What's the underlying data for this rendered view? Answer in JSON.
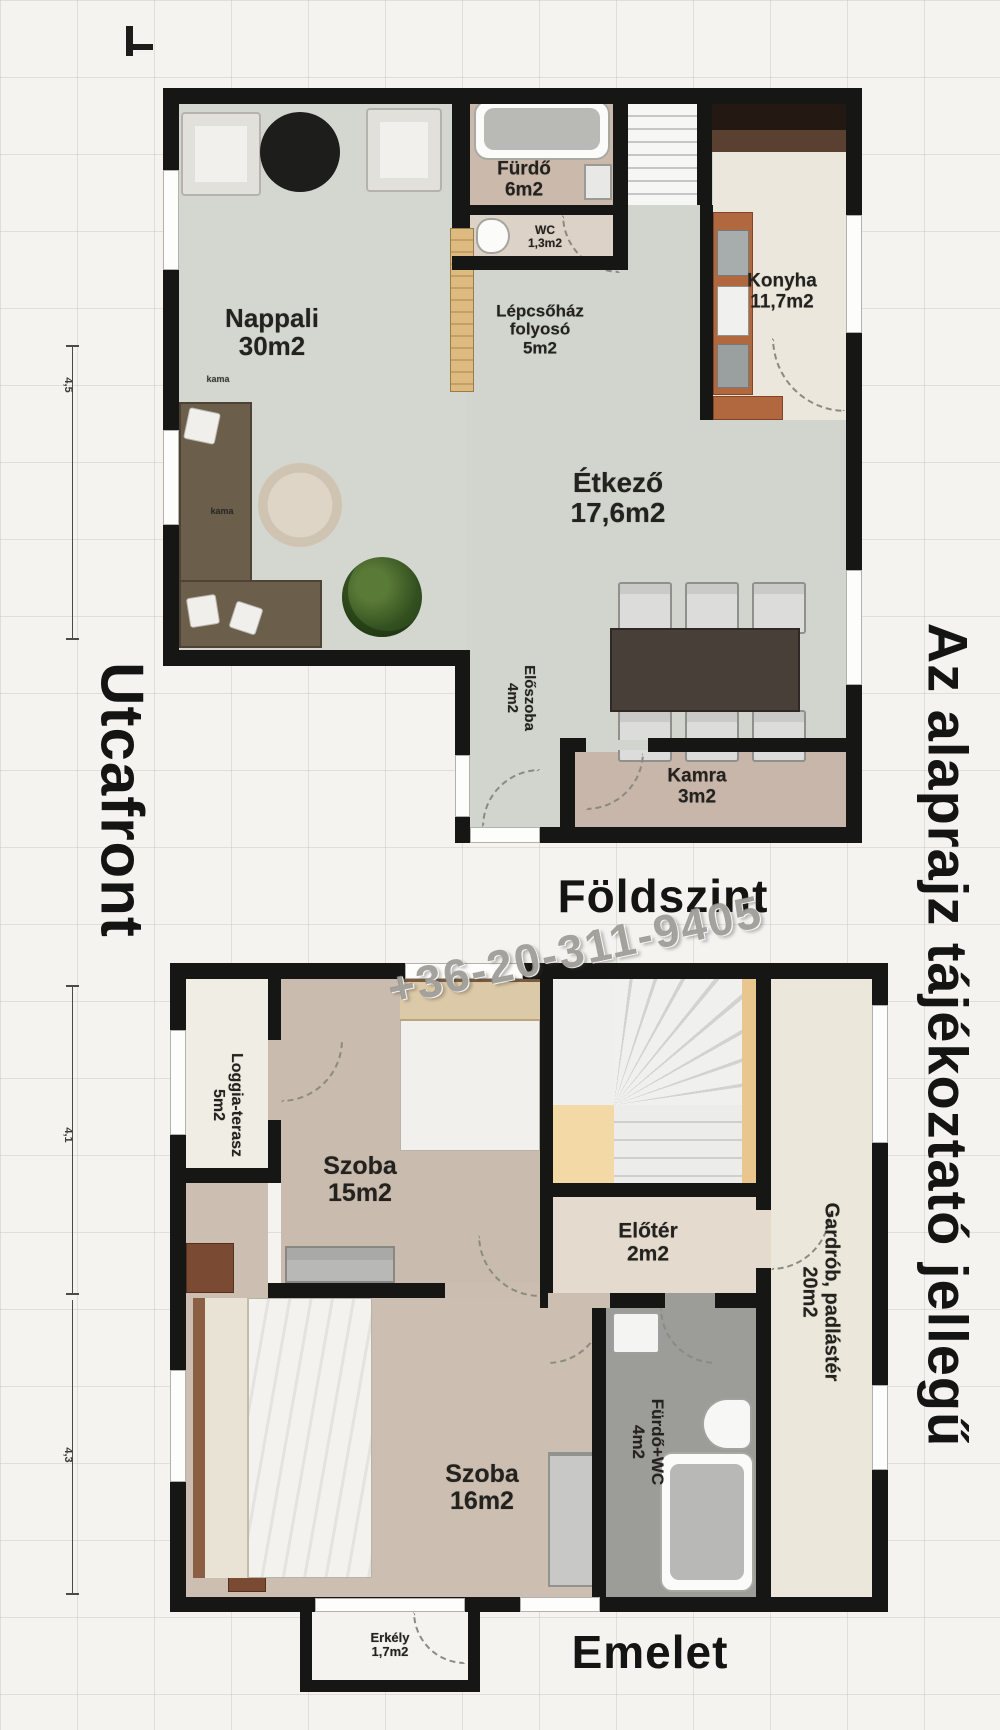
{
  "side_texts": {
    "street_front": "Utcafront",
    "disclaimer": "Az alaprajz tájékoztató jellegű",
    "watermark_phone": "+36-20-311-9405"
  },
  "ground_floor": {
    "title": "Földszint",
    "sofa_tag": "kama",
    "rooms": {
      "nappali": {
        "name": "Nappali",
        "area": "30m2"
      },
      "furdo": {
        "name": "Fürdő",
        "area": "6m2"
      },
      "wc": {
        "name": "WC",
        "area": "1,3m2"
      },
      "lepcsohaz": {
        "line1": "Lépcsőház",
        "line2": "folyosó",
        "area": "5m2"
      },
      "konyha": {
        "name": "Konyha",
        "area": "11,7m2"
      },
      "etkezo": {
        "name": "Étkező",
        "area": "17,6m2"
      },
      "eloszoba": {
        "name": "Előszoba",
        "area": "4m2"
      },
      "kamra": {
        "name": "Kamra",
        "area": "3m2"
      }
    }
  },
  "upper_floor": {
    "title": "Emelet",
    "rooms": {
      "loggia": {
        "name": "Loggia-terasz",
        "area": "5m2"
      },
      "szoba15": {
        "name": "Szoba",
        "area": "15m2"
      },
      "eloter": {
        "name": "Előtér",
        "area": "2m2"
      },
      "gardrob": {
        "name": "Gardrób, padlástér",
        "area": "20m2"
      },
      "furdo_wc": {
        "name": "Fürdő+WC",
        "area": "4m2"
      },
      "szoba16": {
        "name": "Szoba",
        "area": "16m2"
      },
      "erkely": {
        "name": "Erkély",
        "area": "1,7m2"
      }
    }
  },
  "dimensions": {
    "d1": "4,5",
    "d2": "4,1",
    "d3": "4,3"
  }
}
